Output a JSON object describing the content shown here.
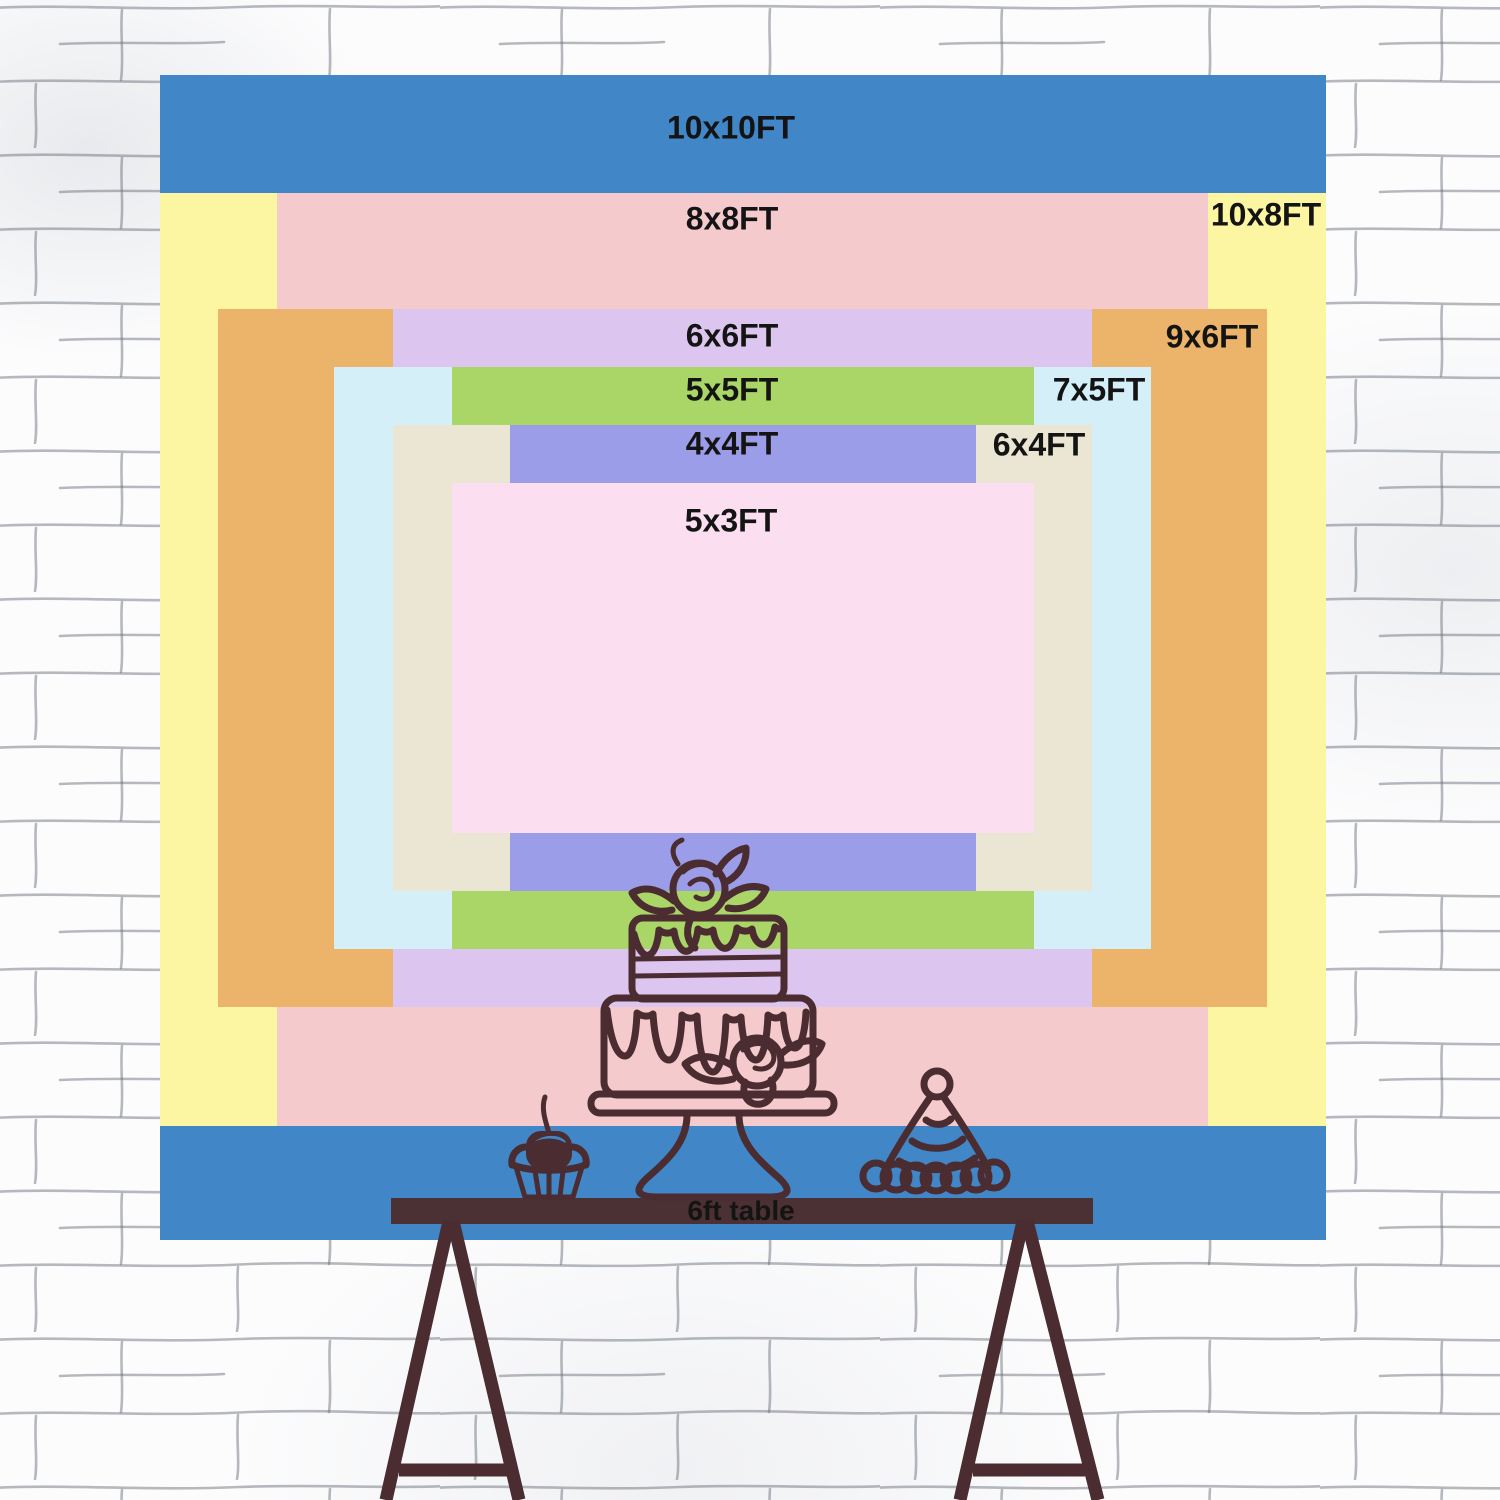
{
  "page": {
    "width": 1500,
    "height": 1500,
    "background": "#fcfcfd",
    "text_color": "#141414"
  },
  "wall": {
    "name": "white-brick-wall",
    "brick_line_color": "#6d737d"
  },
  "backdrop": {
    "description": "nested backdrop size comparison",
    "sizes": [
      {
        "id": "10x10",
        "label": "10x10FT",
        "color": "#4186c7"
      },
      {
        "id": "10x8",
        "label": "10x8FT",
        "color": "#fcf6a2"
      },
      {
        "id": "8x8",
        "label": "8x8FT",
        "color": "#f4cacd"
      },
      {
        "id": "9x6",
        "label": "9x6FT",
        "color": "#ecb46a"
      },
      {
        "id": "6x6",
        "label": "6x6FT",
        "color": "#dcc6f0"
      },
      {
        "id": "7x5",
        "label": "7x5FT",
        "color": "#d5eff9"
      },
      {
        "id": "5x5",
        "label": "5x5FT",
        "color": "#a9d666"
      },
      {
        "id": "6x4",
        "label": "6x4FT",
        "color": "#ebe5d3"
      },
      {
        "id": "4x4",
        "label": "4x4FT",
        "color": "#9c9de8"
      },
      {
        "id": "5x3",
        "label": "5x3FT",
        "color": "#fbdff0"
      }
    ]
  },
  "table": {
    "label": "6ft table",
    "top_color": "#4b3133"
  },
  "artwork": {
    "line_color": "#4a2c31",
    "cherry_highlight_color": "#4186c7",
    "items": [
      "tiered-cake-on-stand",
      "cupcake-with-cherry",
      "party-hat",
      "trestle-legs"
    ]
  }
}
